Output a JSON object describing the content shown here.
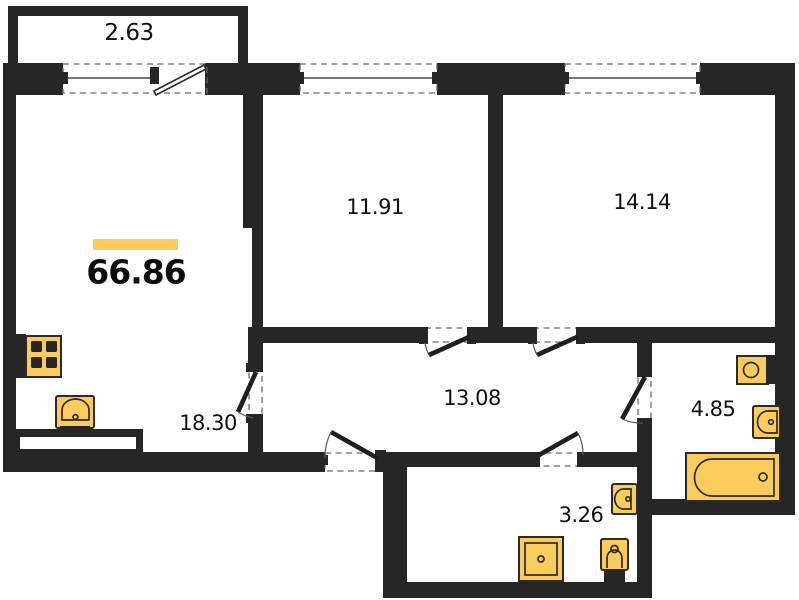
{
  "plan": {
    "total_area": "66.86",
    "rooms": {
      "balcony": {
        "area": "2.63"
      },
      "room_a": {
        "area": "11.91"
      },
      "room_b": {
        "area": "14.14"
      },
      "hallway": {
        "area": "13.08"
      },
      "kitchen_living": {
        "area": "18.30"
      },
      "bathroom": {
        "area": "4.85"
      },
      "wc": {
        "area": "3.26"
      }
    },
    "fixtures": [
      "stove-icon",
      "kitchen-sink-icon",
      "kitchen-counter",
      "shower-tray-icon",
      "toilet-icon",
      "wall-sink-icon",
      "washing-machine-icon",
      "toilet-icon",
      "bathtub-icon"
    ],
    "colors": {
      "wall": "#262626",
      "fixture": "#FBCB5B",
      "accent_bar": "#FBCB5B",
      "background": "#ffffff",
      "text": "#111111"
    }
  }
}
